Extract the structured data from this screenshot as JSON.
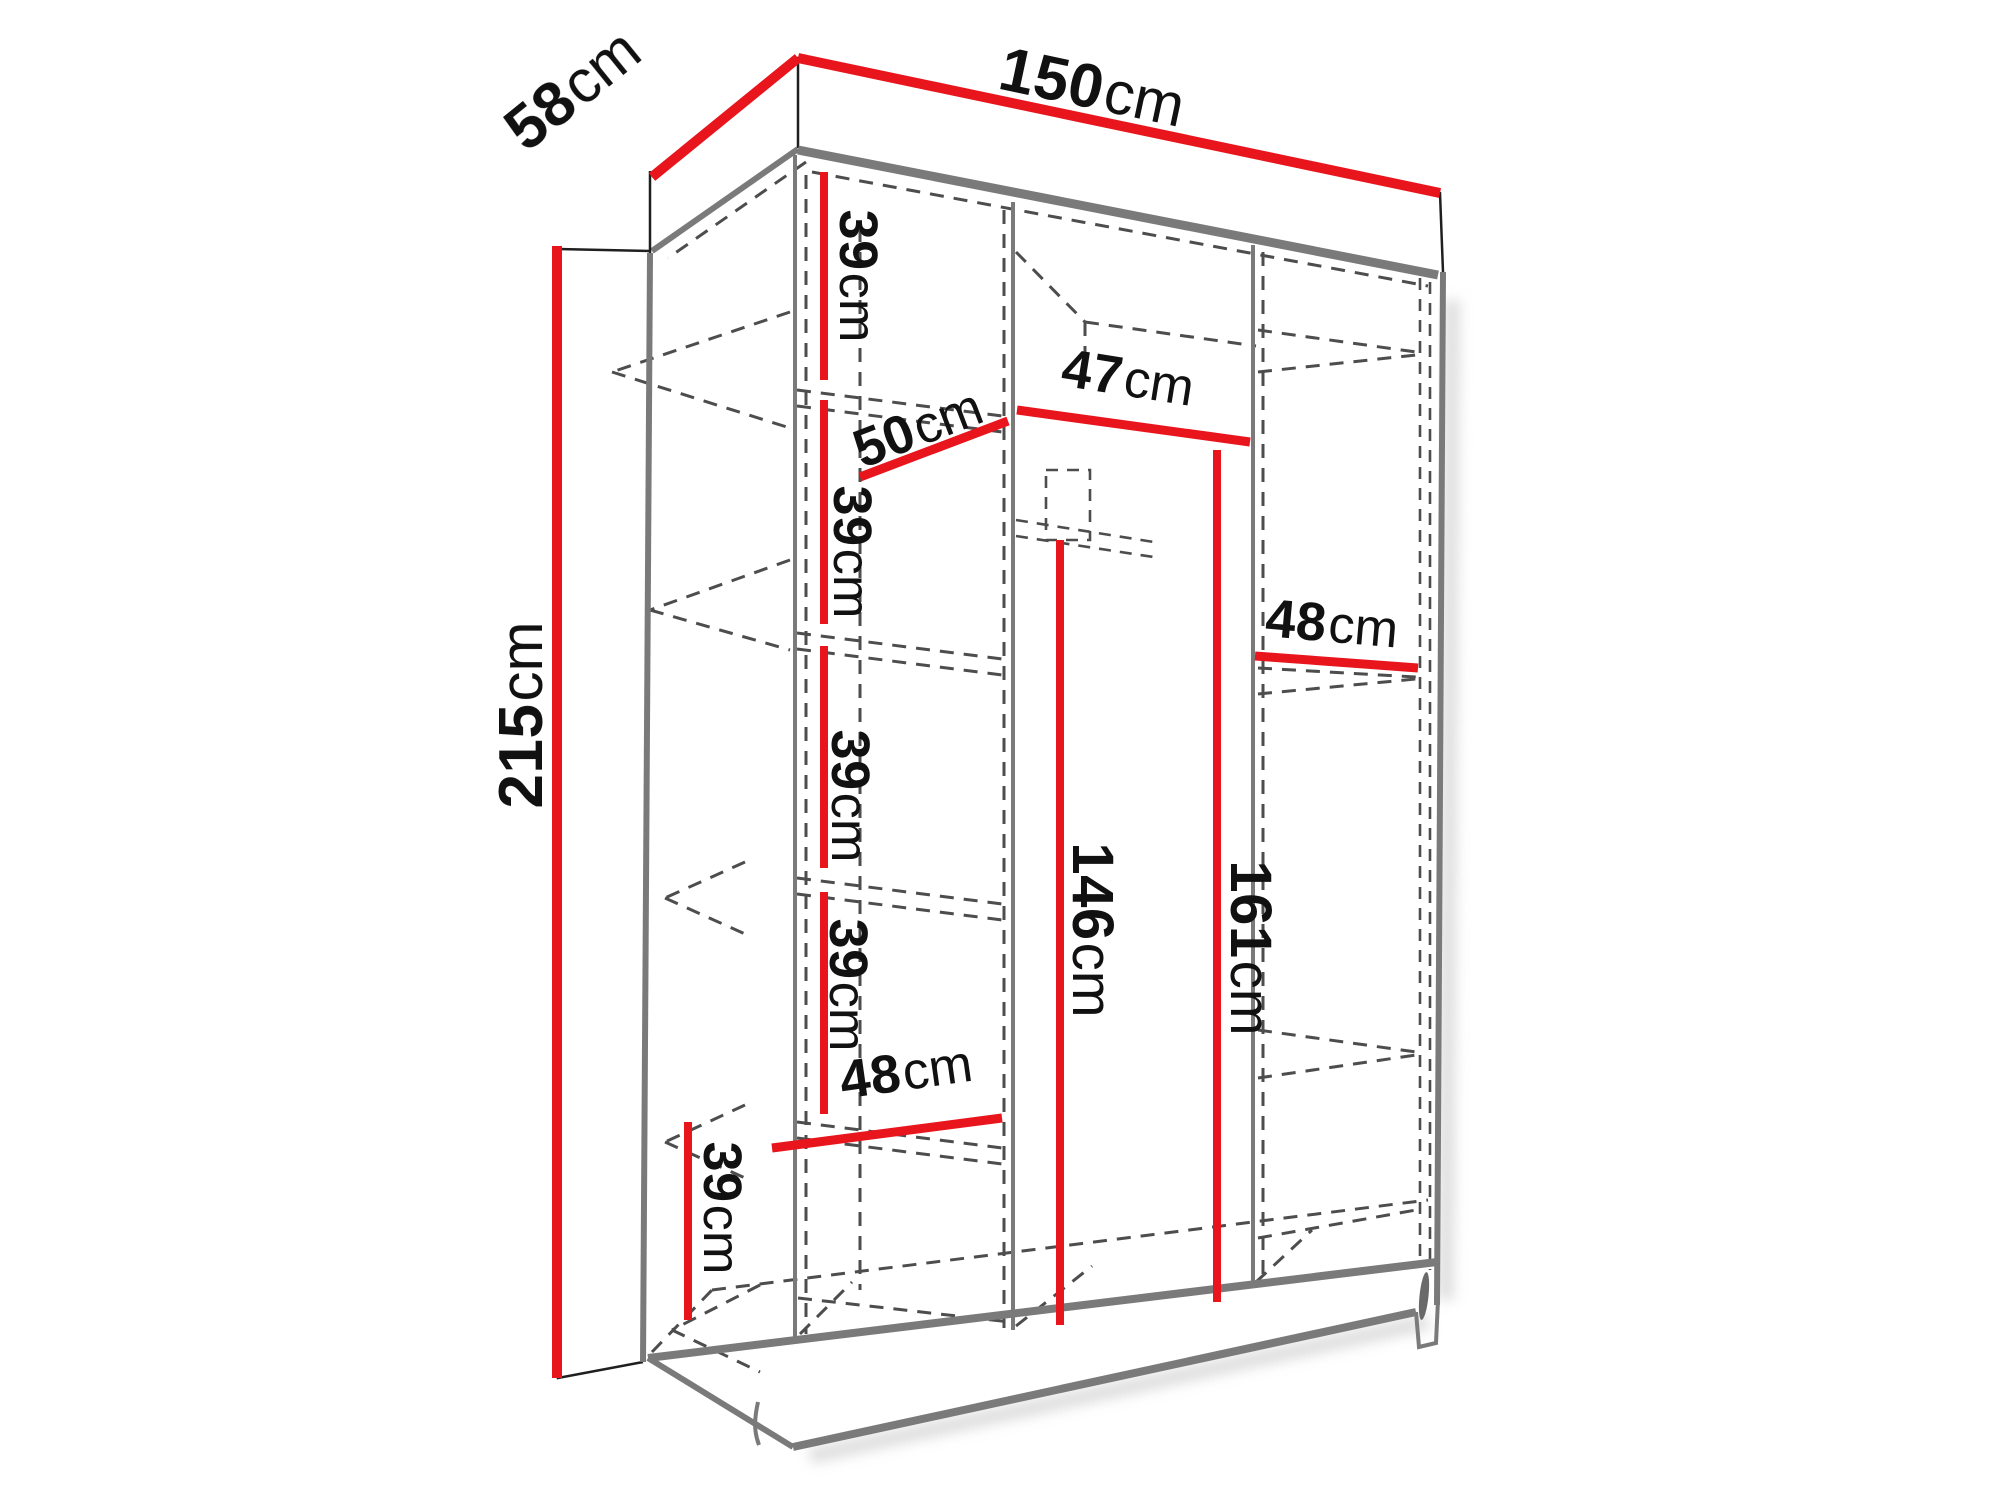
{
  "diagram_type": "wardrobe-dimension-drawing",
  "colors": {
    "dimension_red": "#e8151d",
    "edge_gray": "#7a7a7a",
    "line_black": "#1f1f1f",
    "dash_gray": "#4d4d4d",
    "text_black": "#111111",
    "background": "#ffffff",
    "shadow": "#c9c9c9"
  },
  "labels": {
    "top_width": {
      "value": "150",
      "unit": "cm"
    },
    "top_depth": {
      "value": "58",
      "unit": "cm"
    },
    "left_height": {
      "value": "215",
      "unit": "cm"
    },
    "left_col_gap_1": {
      "value": "39",
      "unit": "cm"
    },
    "left_col_gap_2": {
      "value": "39",
      "unit": "cm"
    },
    "left_col_gap_3": {
      "value": "39",
      "unit": "cm"
    },
    "left_col_gap_4": {
      "value": "39",
      "unit": "cm"
    },
    "bottom_left_gap": {
      "value": "39",
      "unit": "cm"
    },
    "shelf_diag_depth": {
      "value": "50",
      "unit": "cm"
    },
    "middle_top_width": {
      "value": "47",
      "unit": "cm"
    },
    "right_shelf_width": {
      "value": "48",
      "unit": "cm"
    },
    "middle_rod_height": {
      "value": "146",
      "unit": "cm"
    },
    "right_inner_height": {
      "value": "161",
      "unit": "cm"
    },
    "left_col_bottom_width": {
      "value": "48",
      "unit": "cm"
    }
  }
}
